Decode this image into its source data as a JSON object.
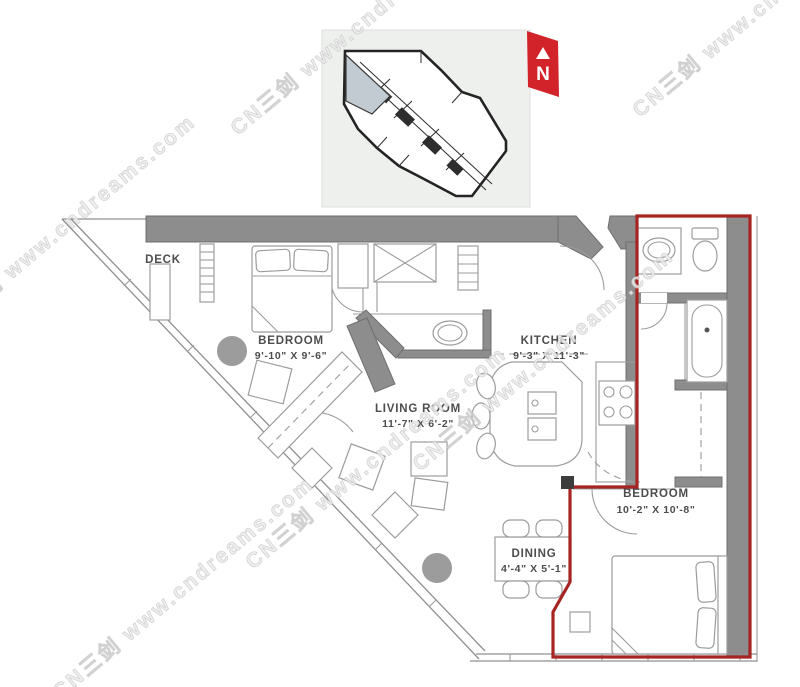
{
  "floor_plan": {
    "rooms": [
      {
        "id": "deck",
        "name": "DECK",
        "dims": ""
      },
      {
        "id": "bedroom-1",
        "name": "BEDROOM",
        "dims": "9'-10\" X 9'-6\""
      },
      {
        "id": "living-room",
        "name": "LIVING ROOM",
        "dims": "11'-7\" X 6'-2\""
      },
      {
        "id": "kitchen",
        "name": "KITCHEN",
        "dims": "9'-3\" X 11'-3\""
      },
      {
        "id": "dining",
        "name": "DINING",
        "dims": "4'-4\" X 5'-1\""
      },
      {
        "id": "bedroom-2",
        "name": "BEDROOM",
        "dims": "10'-2\" X 10'-8\""
      }
    ],
    "north_indicator": {
      "label": "N"
    },
    "watermark": {
      "text": "CN三剑  www.cndreams.com"
    },
    "colors": {
      "wall_gray": "#8d8d8d",
      "furniture_line_gray": "#9c9c9c",
      "unit_boundary_red": "#a62422",
      "north_red": "#d2232a",
      "keyplan_background": "#eef0ee",
      "keyplan_highlight": "#c2cbd1",
      "watermark_gray": "#d6d6d6"
    }
  }
}
